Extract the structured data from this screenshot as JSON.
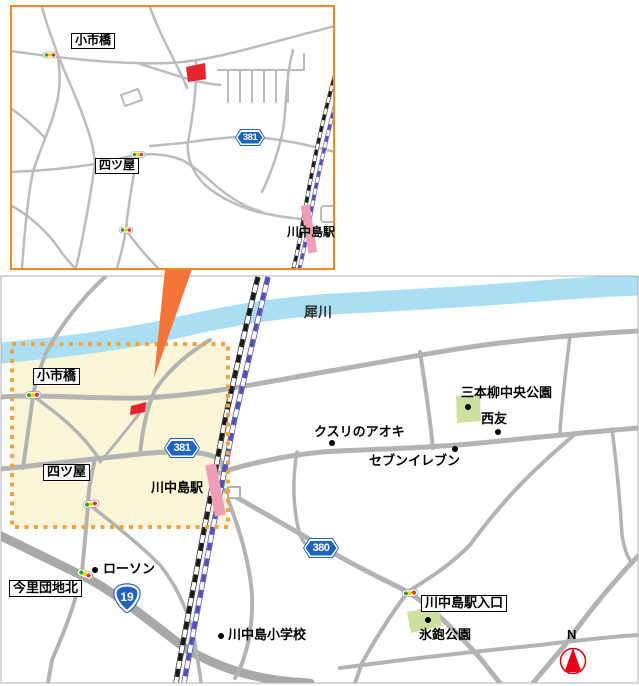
{
  "inset": {
    "labels": {
      "koichibashi": "小市橋",
      "yotsuya": "四ツ屋",
      "station": "川中島駅"
    },
    "route_381": "381"
  },
  "main": {
    "river": "犀川",
    "labels": {
      "koichibashi": "小市橋",
      "yotsuya": "四ツ屋",
      "station": "川中島駅",
      "sanbonyanagi_park": "三本柳中央公園",
      "kusuri_no_aoki": "クスリのアオキ",
      "seiyu": "西友",
      "seven_eleven": "セブンイレブン",
      "lawson": "ローソン",
      "imasato_danchi_kita": "今里団地北",
      "elementary_school": "川中島小学校",
      "station_entrance": "川中島駅入口",
      "higano_park": "氷鉋公園"
    },
    "route_381": "381",
    "route_380": "380",
    "route_19": "19",
    "compass_north": "N"
  },
  "colors": {
    "inset_border_orange": "#ef8a1f",
    "callout_wedge_orange": "#f4753a",
    "highlight_fill_yellow": "#fbf5d8",
    "highlight_border_orange": "#f2a53f",
    "river_blue": "#a9def3",
    "railway_black": "#1a1a1a",
    "railway_blue": "#5552b5",
    "station_pink": "#ef9eb6",
    "road_gray": "#b3b3b3",
    "route_shield_blue": "#1f63be",
    "parcel_red": "#e8232b",
    "park_green": "#cee09f",
    "compass_red": "#e60012",
    "signal_green": "#2ba62b",
    "signal_yellow": "#f5d300",
    "signal_red": "#e8382d"
  }
}
